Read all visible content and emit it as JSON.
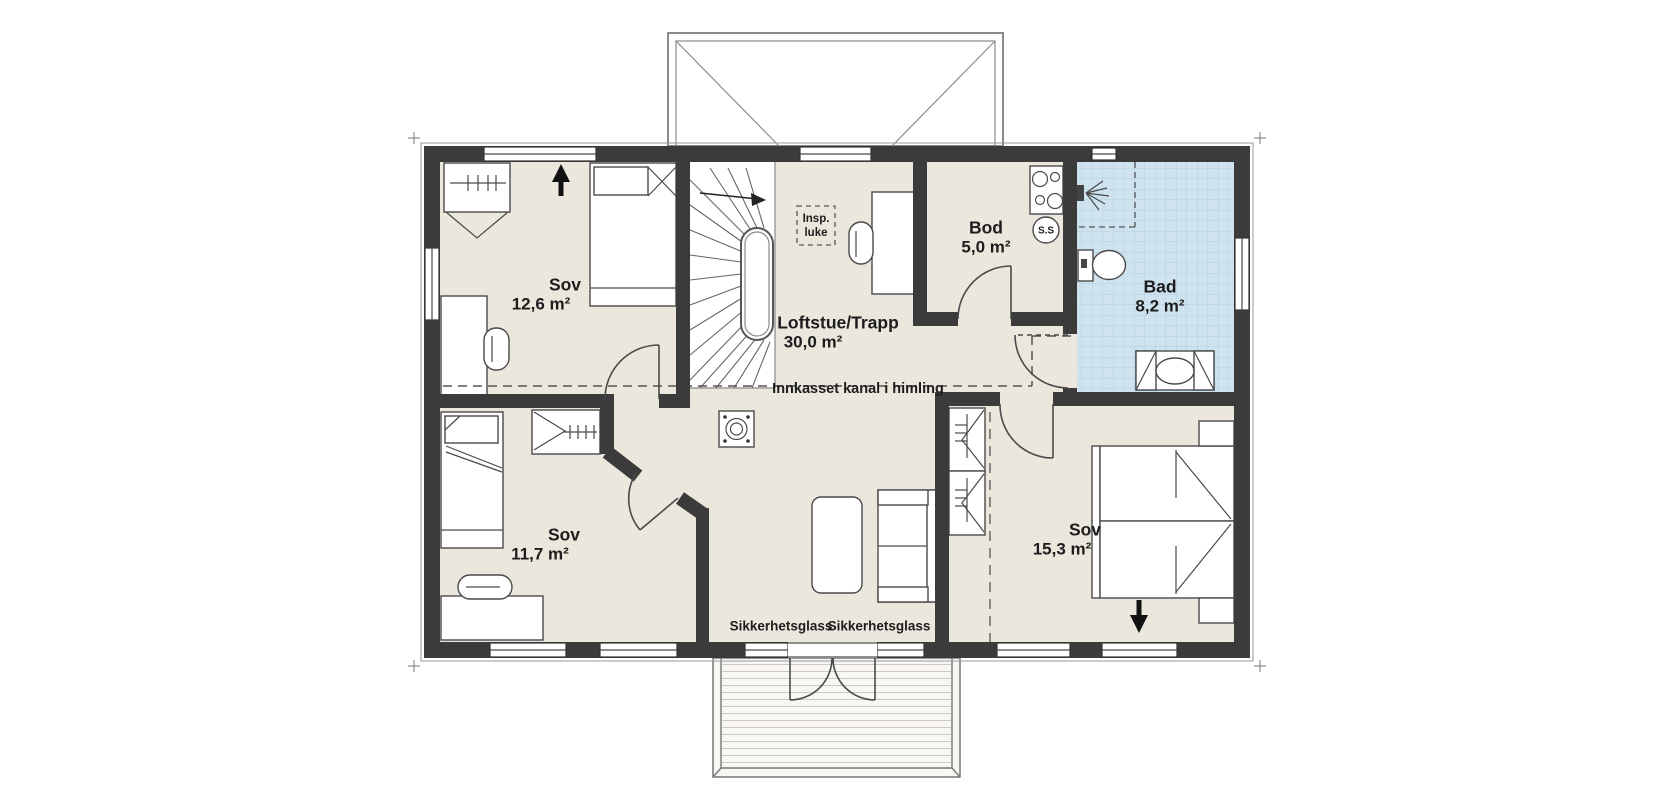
{
  "rooms": {
    "sov1": {
      "name": "Sov",
      "area": "12,6 m²"
    },
    "loftstue": {
      "name": "Loftstue/Trapp",
      "area": "30,0 m²"
    },
    "bod": {
      "name": "Bod",
      "area": "5,0 m²"
    },
    "bad": {
      "name": "Bad",
      "area": "8,2 m²"
    },
    "sov2": {
      "name": "Sov",
      "area": "11,7 m²"
    },
    "sov3": {
      "name": "Sov",
      "area": "15,3 m²"
    }
  },
  "annotations": {
    "duct_label": "Innkasset kanal i himling",
    "safety_glass_left": "Sikkerhetsglass",
    "safety_glass_right": "Sikkerhetsglass",
    "inspection_hatch": {
      "line1": "Insp.",
      "line2": "luke"
    },
    "ss_marker": "S.S"
  },
  "colors": {
    "floor": "#ebe7dd",
    "bath_floor": "#cfe3ef",
    "bath_grid": "#b2cfe1",
    "wall": "#3b3b3b",
    "outline": "#4c4c4c",
    "text": "#1d1d1d"
  }
}
